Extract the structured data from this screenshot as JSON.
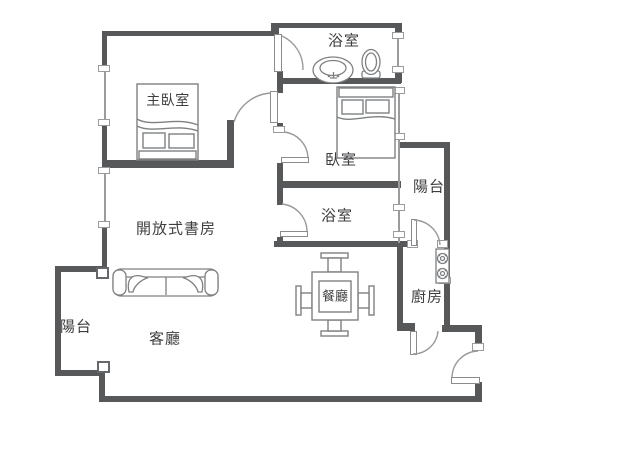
{
  "canvas": {
    "width": 640,
    "height": 462
  },
  "colors": {
    "wall": "#57585a",
    "window_line": "#9b9b9d",
    "furniture_line": "#7e8082",
    "door_arc": "#98999b",
    "text": "#3e3e40",
    "background": "#ffffff"
  },
  "rooms": {
    "bathroom_top": {
      "label": "浴室"
    },
    "master_bedroom": {
      "label": "主臥室"
    },
    "bedroom": {
      "label": "臥室"
    },
    "balcony_right": {
      "label": "陽台"
    },
    "bathroom_middle": {
      "label": "浴室"
    },
    "study": {
      "label": "開放式書房"
    },
    "dining_room": {
      "label": "餐廳"
    },
    "kitchen": {
      "label": "廚房"
    },
    "balcony_left": {
      "label": "陽台"
    },
    "living_room": {
      "label": "客廳"
    }
  },
  "fixtures": {
    "sink": "sink-icon",
    "toilet": "toilet-icon",
    "stove": "stove-icon",
    "master_bed": "double-bed-icon",
    "bedroom_bed": "double-bed-icon",
    "sofa": "sofa-icon",
    "dining_table": "dining-table-icon"
  }
}
